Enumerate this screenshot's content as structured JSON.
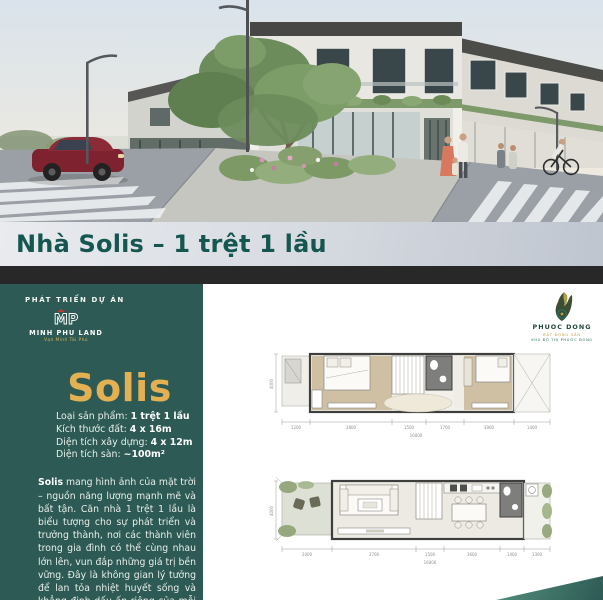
{
  "title_bar": {
    "title": "Nhà Solis – 1 trệt 1 lầu"
  },
  "sidebar": {
    "developer_label": "PHÁT TRIỂN DỰ ÁN",
    "developer_monogram": "MP",
    "developer_name": "MINH PHU LAND",
    "developer_tagline": "Vạn Minh Tài Phú",
    "product_name": "Solis",
    "specs": [
      {
        "label": "Loại sản phẩm: ",
        "value": "1 trệt 1 lầu"
      },
      {
        "label": "Kích thước đất: ",
        "value": "4 x 16m"
      },
      {
        "label": "Diện tích xây dựng: ",
        "value": "4 x 12m"
      },
      {
        "label": "Diện tích sàn: ",
        "value": "~100m²"
      }
    ],
    "description_bold": "Solis",
    "description_rest": " mang hình ảnh của mặt trời – nguồn năng lượng mạnh mẽ và bất tận. Căn nhà 1 trệt 1 lầu là biểu tượng cho sự phát triển và trưởng thành, nơi các thành viên trong gia đình có thể cùng nhau lớn lên, vun đắp những giá trị bền vững. Đây là không gian lý tưởng để lan tỏa nhiệt huyết sống và khẳng định dấu ấn riêng của mỗi người."
  },
  "partner": {
    "name": "PHUOC DONG",
    "tagline_gold": "BẤT ĐỘNG SẢN",
    "tagline_teal": "KHU ĐÔ THỊ PHƯỚC ĐÔNG"
  },
  "plans": {
    "upper": {
      "dims": [
        "1200",
        "3800",
        "1500",
        "1700",
        "3900",
        "1400"
      ],
      "total": "16000",
      "side": "4000"
    },
    "ground": {
      "dims": [
        "2000",
        "3700",
        "1500",
        "3600",
        "1400",
        "1300"
      ],
      "total": "16000",
      "side": "4000"
    }
  }
}
